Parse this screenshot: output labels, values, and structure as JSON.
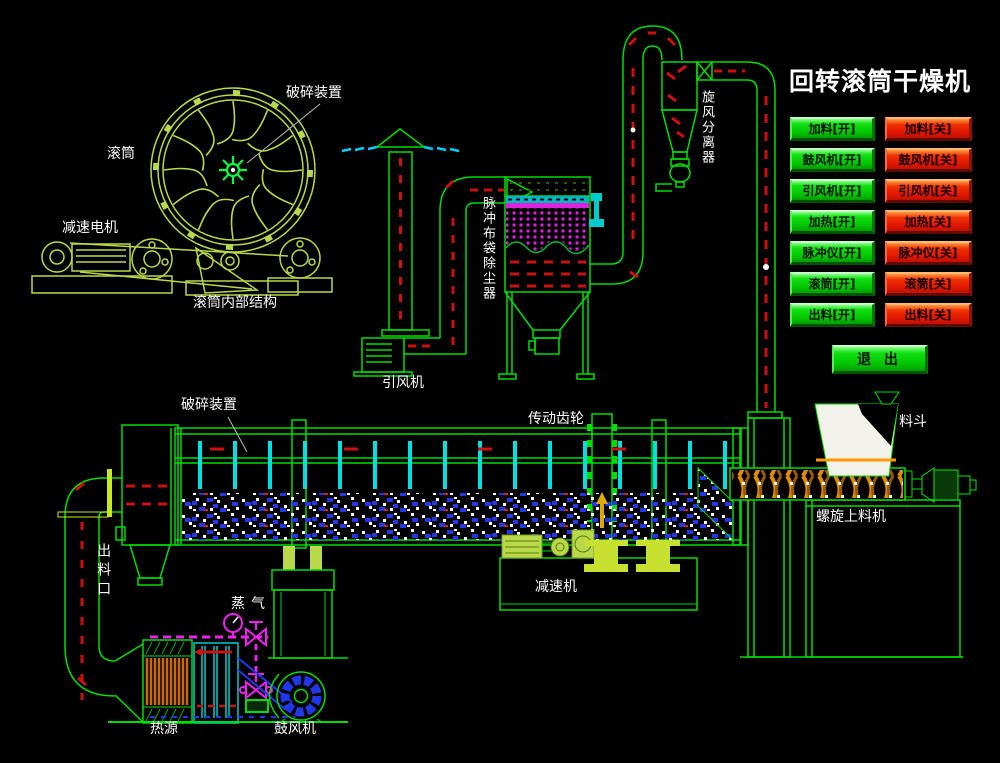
{
  "header": {
    "title": "回转滚筒干燥机"
  },
  "panel": {
    "rows": [
      {
        "name": "feed",
        "on": "加料[开]",
        "off": "加料[关]"
      },
      {
        "name": "blower",
        "on": "鼓风机[开]",
        "off": "鼓风机[关]"
      },
      {
        "name": "draft-fan",
        "on": "引风机[开]",
        "off": "引风机[关]"
      },
      {
        "name": "heating",
        "on": "加热[开]",
        "off": "加热[关]"
      },
      {
        "name": "pulse-meter",
        "on": "脉冲仪[开]",
        "off": "脉冲仪[关]"
      },
      {
        "name": "drum",
        "on": "滚筒[开]",
        "off": "滚筒[关]"
      },
      {
        "name": "discharge",
        "on": "出料[开]",
        "off": "出料[关]"
      }
    ],
    "exit_label": "退 出",
    "colors": {
      "on_button": "#00c400",
      "off_button": "#e01600",
      "button_text": "#000000"
    }
  },
  "diagram": {
    "labels": {
      "crusher_top": "破碎装置",
      "drum_section": "滚筒",
      "gear_motor": "减速电机",
      "drum_internal": "滚筒内部结构",
      "pulse_bag_filter": "脉冲布袋除尘器",
      "cyclone_separator": "旋风分离器",
      "induced_draft_fan": "引风机",
      "crusher_drum": "破碎装置",
      "drive_gear": "传动齿轮",
      "hopper": "料斗",
      "screw_feeder": "螺旋上料机",
      "reducer": "减速机",
      "discharge_port": "出料口",
      "steam": "蒸气",
      "heat_source": "热源",
      "blower": "鼓风机"
    },
    "colors": {
      "line_green": "#00dd00",
      "cad_yellow_green": "#b9d94a",
      "flow_red": "#cc1111",
      "paddle_cyan": "#00e0e0",
      "filter_magenta": "#dd22dd",
      "impeller_blue": "#2238e8",
      "heater_orange": "#cc6a00",
      "screw_orange": "#e08a00",
      "exhaust_cyan": "#00ccff",
      "label_text": "#ffffff",
      "background": "#000000"
    }
  }
}
